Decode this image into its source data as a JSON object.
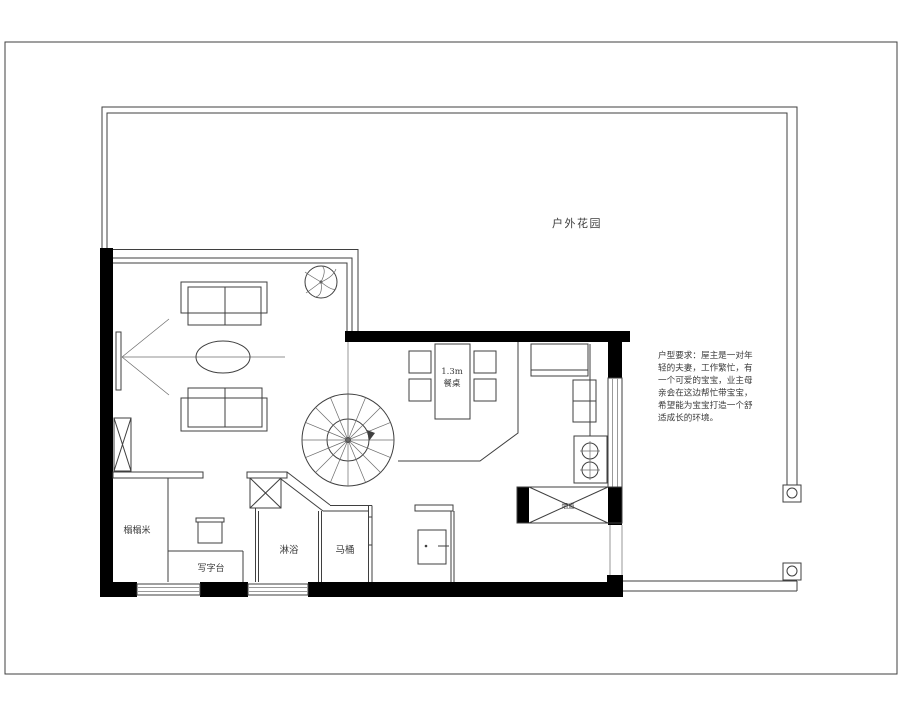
{
  "labels": {
    "garden": "户外花园",
    "dining_dim": "1.3m",
    "dining_table": "餐桌",
    "tatami": "榻榻米",
    "writing_desk": "写字台",
    "shower": "淋浴",
    "toilet": "马桶",
    "flue": "烟道"
  },
  "notes": {
    "lines": [
      "户型要求：屋主是一对年",
      "轻的夫妻，工作繁忙，有",
      "一个可爱的宝宝，业主母",
      "亲会在这边帮忙带宝宝，",
      "希望能为宝宝打造一个舒",
      "适成长的环境。"
    ]
  },
  "colors": {
    "background": "#ffffff",
    "line": "#3f3f3f",
    "wall": "#000000",
    "text": "#3b3b3b"
  }
}
